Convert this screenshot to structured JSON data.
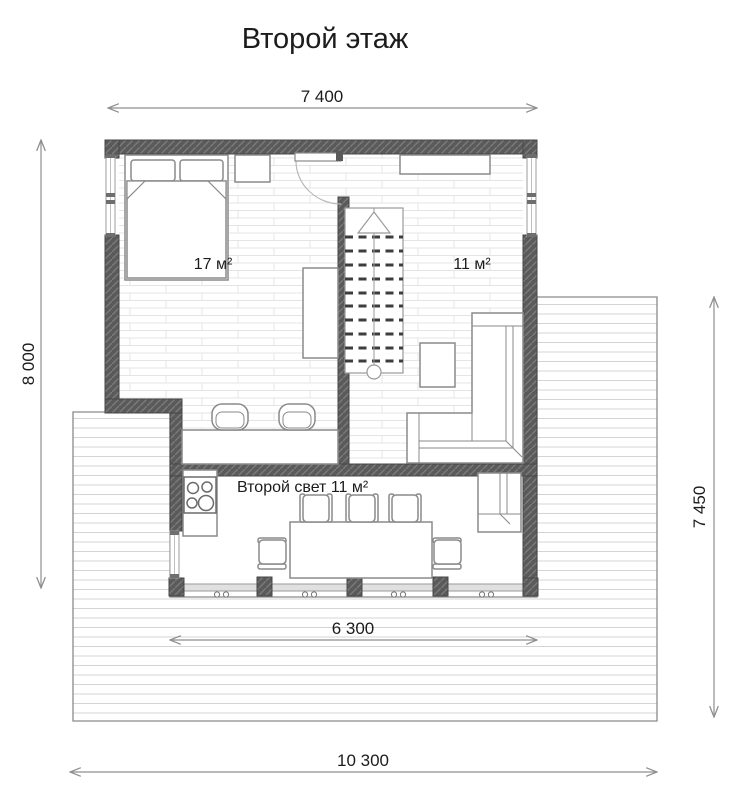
{
  "title": "Второй этаж",
  "dimensions": {
    "top": "7 400",
    "left": "8 000",
    "right": "7 450",
    "inner_bottom": "6 300",
    "outer_bottom": "10 300"
  },
  "rooms": {
    "bedroom": "17 м²",
    "hall": "11 м²",
    "second_light": "Второй свет 11 м²"
  },
  "colors": {
    "wall": "#5a5a5a",
    "dimension_line": "#8f8f8f",
    "text": "#1c1c1c",
    "floor_plank_line": "#e4e4e4",
    "deck_line": "#d4d4d4",
    "furniture_outline": "#8a8a8a"
  }
}
